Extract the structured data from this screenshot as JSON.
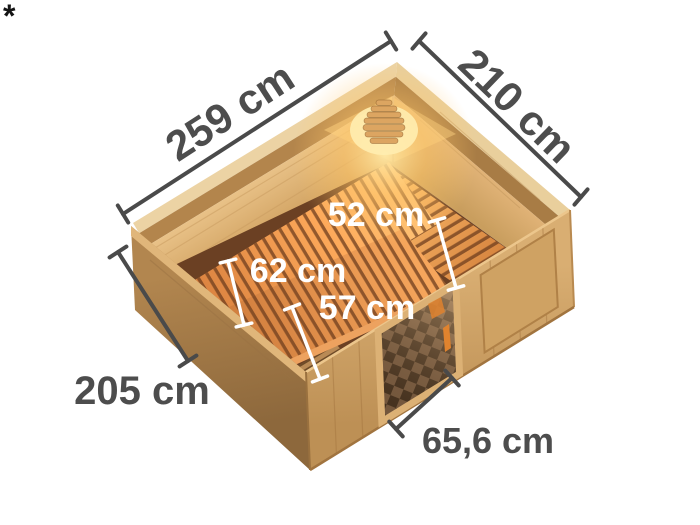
{
  "footnote_marker": "*",
  "dimensions": {
    "external": [
      {
        "name": "roof-edge-left",
        "label": "259 cm",
        "value_cm": 259
      },
      {
        "name": "roof-edge-right",
        "label": "210 cm",
        "value_cm": 210
      },
      {
        "name": "left-side",
        "label": "205 cm",
        "value_cm": 205
      },
      {
        "name": "door-width",
        "label": "65,6 cm",
        "value_cm": 65.6
      }
    ],
    "internal": [
      {
        "name": "side-bench-depth",
        "label": "52 cm",
        "value_cm": 52
      },
      {
        "name": "main-bench-depth",
        "label": "62 cm",
        "value_cm": 62
      },
      {
        "name": "front-bench-depth",
        "label": "57 cm",
        "value_cm": 57
      }
    ]
  },
  "colors": {
    "background": "#ffffff",
    "dimension_line": "#4a4a4a",
    "dimension_label": "#4d4d4d",
    "internal_label": "#ffffff",
    "wood_light": "#dcb077",
    "wood_crown_dark": "#b3854c",
    "bench_orange": "#e8924a",
    "lamp_glow": "#ffd47e",
    "door_glass_dark": "#46321f"
  }
}
